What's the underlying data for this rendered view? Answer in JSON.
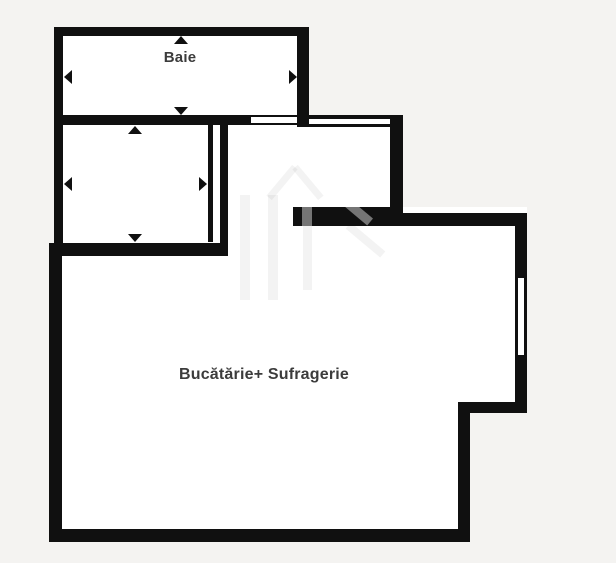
{
  "plan": {
    "type": "apartment-floor-plan",
    "rooms": {
      "baie": {
        "label": "Baie"
      },
      "camera": {
        "label": ""
      },
      "living": {
        "label": "Bucătărie+ Sufragerie"
      }
    }
  },
  "colors": {
    "background": "#f4f3f1",
    "wall": "#101010",
    "room_fill": "#ffffff",
    "label_text": "#3c3c3c",
    "watermark": "#8f8f8f"
  }
}
